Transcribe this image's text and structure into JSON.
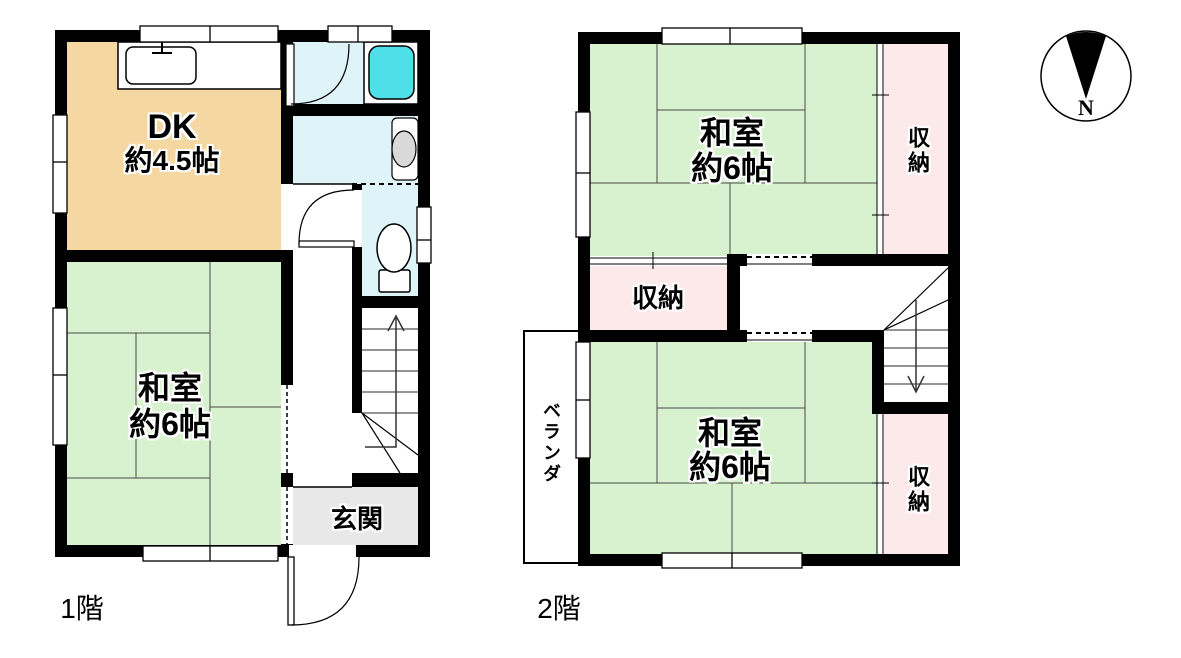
{
  "colors": {
    "wall": "#000000",
    "dk_room": "#F5D8A1",
    "tatami_room": "#D8F2CF",
    "storage_room": "#FBEAE9",
    "wet_area": "#DFF4F8",
    "bathtub": "#4FDFE9",
    "genkan": "#E8E8E8",
    "fixture": "#D9D9D9"
  },
  "floor1": {
    "floor_label": "1階",
    "dk": {
      "line1": "DK",
      "line2": "約4.5帖"
    },
    "washitsu": {
      "line1": "和室",
      "line2": "約6帖"
    },
    "genkan_label": "玄関"
  },
  "floor2": {
    "floor_label": "2階",
    "washitsu_upper": {
      "line1": "和室",
      "line2": "約6帖"
    },
    "washitsu_lower": {
      "line1": "和室",
      "line2": "約6帖"
    },
    "storage_upper": "収納",
    "storage_middle": "収納",
    "storage_lower": "収納",
    "veranda": "ベランダ"
  },
  "compass": {
    "north_label": "N"
  }
}
